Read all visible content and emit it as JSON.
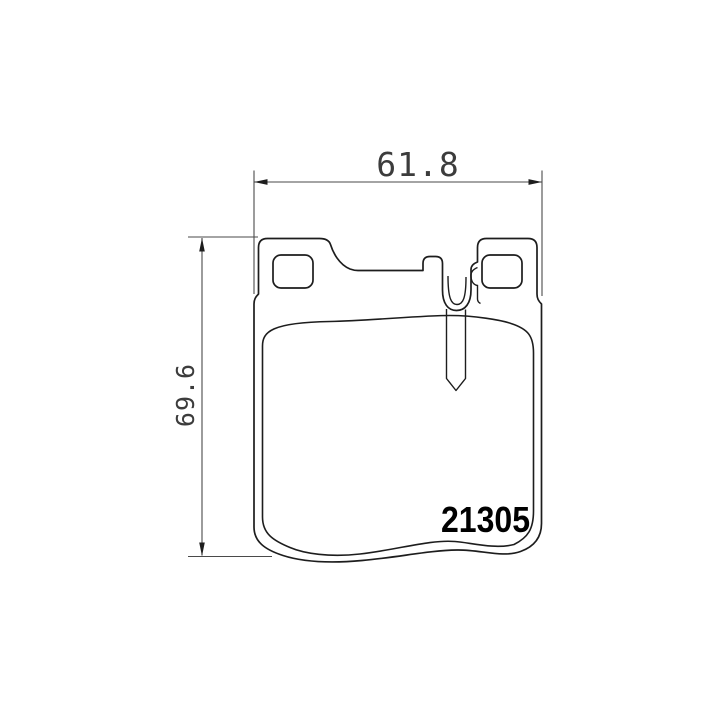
{
  "drawing": {
    "part_number": "21305",
    "dimensions": {
      "width_mm": "61.8",
      "height_mm": "69.6"
    },
    "colors": {
      "background": "#ffffff",
      "outline": "#1d1d1d",
      "dimension_lines": "#4a4a4a",
      "dimension_text": "#3c3c3c",
      "part_number_text": "#000000"
    }
  }
}
